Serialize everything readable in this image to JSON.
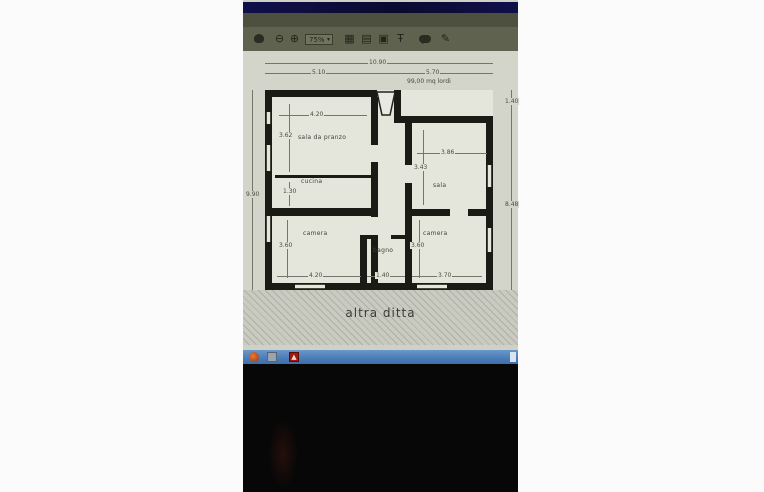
{
  "toolbar": {
    "zoom_level": "75%",
    "icons": {
      "zoom_out": "⊖",
      "zoom_in": "⊕",
      "fit_width": "▦",
      "page_view": "▤",
      "fullscreen": "▣",
      "tools": "Ŧ",
      "pencil": "✎"
    }
  },
  "floor_plan": {
    "dims": {
      "total_width": "10.90",
      "left_width": "5.10",
      "right_width": "5.70",
      "area": "99,00 mq lordi",
      "left_height": "9.90",
      "right_height_top": "1.40",
      "right_height_bottom": "8.48",
      "pranzo_w": "4.20",
      "pranzo_h": "3.62",
      "cucina_h": "1.30",
      "sala_w": "3.86",
      "sala_h": "3.43",
      "camera_l_w": "4.20",
      "camera_l_h": "3.60",
      "bagno_w": "1.40",
      "camera_r_w": "3.70",
      "camera_r_h": "3.60"
    },
    "rooms": {
      "pranzo": "sala da pranzo",
      "cucina": "cucina",
      "sala": "sala",
      "camera_left": "camera",
      "bagno": "bagno",
      "camera_right": "camera"
    },
    "caption": "altra ditta"
  },
  "taskbar": {
    "icons": [
      "browser-icon",
      "explorer-icon",
      "adobe-reader-icon"
    ]
  },
  "colors": {
    "titlebar_navy": "#10104a",
    "toolbar_olive": "#5f624e",
    "taskbar_blue": "#4a7cb8",
    "adobe_red": "#a1170e",
    "wall_black": "#1b1b16"
  }
}
